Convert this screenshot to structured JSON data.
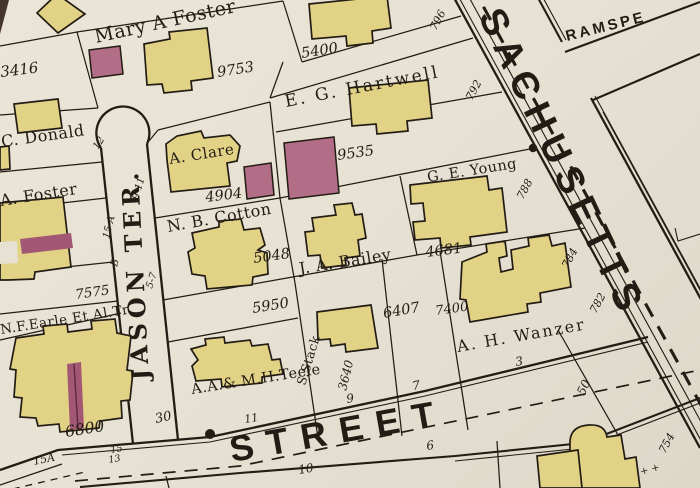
{
  "colors": {
    "paper": "#e6e1d3",
    "ink": "#231c14",
    "building_yellow": "#e2d286",
    "building_pink": "#b26e87",
    "band_maroon": "#a25874",
    "dark_corner": "#44362a"
  },
  "streets": {
    "massachusetts": "SACHUSETTS",
    "street": "STREET",
    "jason_terrace": "JASON TER.",
    "ramsdell": "RAMSPE"
  },
  "owners": {
    "mary_foster": "Mary A Foster",
    "c_donald": "C. Donald",
    "a_foster": "A. Foster",
    "eg_hartwell": "E. G. Hartwell",
    "a_clare": "A. Clare",
    "nb_cotton": "N. B. Cotton",
    "ge_young": "G. E. Young",
    "ja_bailey": "J. A. Bailey",
    "ah_wanzer": "A. H. Wanzer",
    "nf_earle": "N.F.Earle Et Al.Tr.",
    "teele": "A.A.& M.H.Teele",
    "s_stack": "S.Stack"
  },
  "parcel_areas": {
    "a3416": "3416",
    "a9753": "9753",
    "a5400": "5400",
    "a9535": "9535",
    "a4904": "4904",
    "a5048": "5048",
    "a4681": "4681",
    "a5950": "5950",
    "a6407": "6407",
    "a7400": "7400",
    "a7575": "7575",
    "a6800": "6800",
    "a3640": "3640"
  },
  "house_numbers": {
    "m796": "796",
    "m792": "792",
    "m788": "788",
    "m784": "784",
    "m782": "782",
    "m754": "754",
    "j12": "12",
    "j9_11": "9-11",
    "j15a": "15 A",
    "jb": "B",
    "j5_7": "5-7",
    "s30": "30",
    "s11": "11",
    "s9": "9",
    "s7": "7",
    "s3": "3",
    "s50": "50",
    "s6": "6",
    "s10": "10",
    "s15": "15",
    "s13": "13",
    "s15a": "15A"
  },
  "symbols": {
    "crosses": "+ +"
  }
}
